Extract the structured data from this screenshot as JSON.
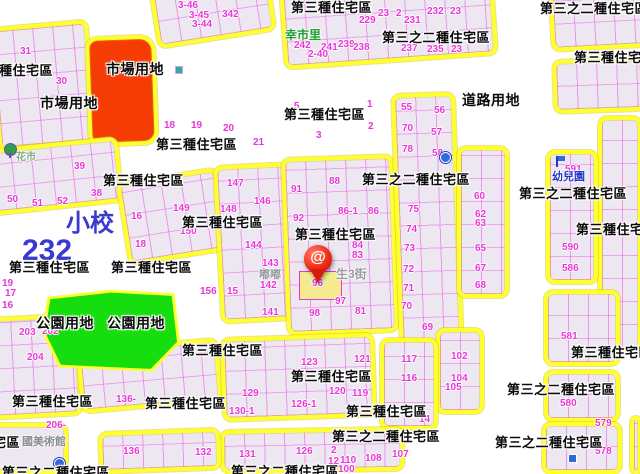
{
  "map": {
    "marker": {
      "glyph": "@",
      "on_parcel": "96"
    },
    "colors": {
      "background": "#ffffff",
      "block_fill": "#ece7f1",
      "parcel_line": "#ee3ee4",
      "zone_border_yellow": "#feff2e",
      "market_red": "#f53c05",
      "park_green": "#16dd0e",
      "highlight_yellow": "#f4eb8e",
      "number_magenta": "#e935d8",
      "label_black": "#0b0b0b",
      "pin_red": "#ef2c17"
    },
    "zone_labels": [
      {
        "t": "第三種住宅區",
        "x": -28,
        "y": 64
      },
      {
        "t": "市場用地",
        "x": 106,
        "y": 62,
        "fs": 14
      },
      {
        "t": "市場用地",
        "x": 40,
        "y": 96,
        "fs": 14
      },
      {
        "t": "第三種住宅區",
        "x": 291,
        "y": 1
      },
      {
        "t": "第三之二種住宅區",
        "x": 382,
        "y": 31
      },
      {
        "t": "第三之二種住宅區",
        "x": 540,
        "y": 2
      },
      {
        "t": "第三種住宅區",
        "x": 574,
        "y": 51
      },
      {
        "t": "道路用地",
        "x": 462,
        "y": 93,
        "fs": 14
      },
      {
        "t": "第三種住宅區",
        "x": 156,
        "y": 138
      },
      {
        "t": "第三種住宅區",
        "x": 284,
        "y": 108
      },
      {
        "t": "第三種住宅區",
        "x": 103,
        "y": 174
      },
      {
        "t": "第三種住宅區",
        "x": 182,
        "y": 216
      },
      {
        "t": "第三種住宅區",
        "x": 295,
        "y": 228
      },
      {
        "t": "第三之二種住宅區",
        "x": 362,
        "y": 173
      },
      {
        "t": "第三種住宅區",
        "x": 9,
        "y": 261
      },
      {
        "t": "第三種住宅區",
        "x": 111,
        "y": 261
      },
      {
        "t": "第三之二種住宅區",
        "x": 519,
        "y": 187
      },
      {
        "t": "第三種住宅區",
        "x": 576,
        "y": 223
      },
      {
        "t": "公園用地",
        "x": 36,
        "y": 316,
        "fs": 14
      },
      {
        "t": "公園用地",
        "x": 107,
        "y": 316,
        "fs": 14
      },
      {
        "t": "第三種住宅區",
        "x": 182,
        "y": 344
      },
      {
        "t": "第三種住宅區",
        "x": 571,
        "y": 346
      },
      {
        "t": "第三種住宅區",
        "x": 12,
        "y": 395
      },
      {
        "t": "第三種住宅區",
        "x": 145,
        "y": 397
      },
      {
        "t": "第三種住宅區",
        "x": 291,
        "y": 370
      },
      {
        "t": "第三種住宅區",
        "x": 346,
        "y": 405
      },
      {
        "t": "第三之二種住宅區",
        "x": 332,
        "y": 430
      },
      {
        "t": "第三之二種住宅區",
        "x": 507,
        "y": 383
      },
      {
        "t": "第三之二種住宅區",
        "x": 495,
        "y": 436
      },
      {
        "t": "第三之二種住宅區",
        "x": 231,
        "y": 465
      },
      {
        "t": "第三之二種住宅區",
        "x": -88,
        "y": 436
      },
      {
        "t": "第三之二種住宅區",
        "x": 2,
        "y": 466
      }
    ],
    "parcel_numbers": [
      {
        "t": "31",
        "x": 20,
        "y": 47
      },
      {
        "t": "30",
        "x": 56,
        "y": 77
      },
      {
        "t": "18",
        "x": 164,
        "y": 121
      },
      {
        "t": "19",
        "x": 191,
        "y": 121
      },
      {
        "t": "3-46",
        "x": 178,
        "y": 1
      },
      {
        "t": "3-45",
        "x": 189,
        "y": 11
      },
      {
        "t": "3-44",
        "x": 192,
        "y": 20
      },
      {
        "t": "342",
        "x": 222,
        "y": 10
      },
      {
        "t": "242",
        "x": 294,
        "y": 41
      },
      {
        "t": "241",
        "x": 321,
        "y": 43
      },
      {
        "t": "239",
        "x": 338,
        "y": 40
      },
      {
        "t": "238",
        "x": 353,
        "y": 43
      },
      {
        "t": "2-40",
        "x": 308,
        "y": 50
      },
      {
        "t": "229",
        "x": 359,
        "y": 16
      },
      {
        "t": "23",
        "x": 378,
        "y": 9
      },
      {
        "t": "2",
        "x": 396,
        "y": 9
      },
      {
        "t": "231",
        "x": 404,
        "y": 16
      },
      {
        "t": "237",
        "x": 401,
        "y": 44
      },
      {
        "t": "232",
        "x": 427,
        "y": 7
      },
      {
        "t": "23",
        "x": 450,
        "y": 7
      },
      {
        "t": "235",
        "x": 427,
        "y": 45
      },
      {
        "t": "23",
        "x": 451,
        "y": 45
      },
      {
        "t": "5",
        "x": 294,
        "y": 102
      },
      {
        "t": "1",
        "x": 367,
        "y": 100
      },
      {
        "t": "3",
        "x": 316,
        "y": 131
      },
      {
        "t": "2",
        "x": 368,
        "y": 122
      },
      {
        "t": "20",
        "x": 223,
        "y": 124
      },
      {
        "t": "21",
        "x": 253,
        "y": 138
      },
      {
        "t": "39",
        "x": 74,
        "y": 162
      },
      {
        "t": "38",
        "x": 91,
        "y": 189
      },
      {
        "t": "50",
        "x": 7,
        "y": 195
      },
      {
        "t": "51",
        "x": 32,
        "y": 199
      },
      {
        "t": "52",
        "x": 57,
        "y": 197
      },
      {
        "t": "16",
        "x": 131,
        "y": 212
      },
      {
        "t": "18",
        "x": 135,
        "y": 240
      },
      {
        "t": "149",
        "x": 173,
        "y": 204
      },
      {
        "t": "150",
        "x": 180,
        "y": 227
      },
      {
        "t": "156",
        "x": 200,
        "y": 287
      },
      {
        "t": "19",
        "x": 2,
        "y": 279
      },
      {
        "t": "17",
        "x": 5,
        "y": 289
      },
      {
        "t": "16",
        "x": 2,
        "y": 301
      },
      {
        "t": "147",
        "x": 227,
        "y": 179
      },
      {
        "t": "146",
        "x": 254,
        "y": 197
      },
      {
        "t": "148",
        "x": 220,
        "y": 205
      },
      {
        "t": "144",
        "x": 245,
        "y": 241
      },
      {
        "t": "143",
        "x": 262,
        "y": 259
      },
      {
        "t": "142",
        "x": 260,
        "y": 281
      },
      {
        "t": "15",
        "x": 227,
        "y": 287
      },
      {
        "t": "141",
        "x": 262,
        "y": 308
      },
      {
        "t": "88",
        "x": 329,
        "y": 177
      },
      {
        "t": "91",
        "x": 291,
        "y": 185
      },
      {
        "t": "92",
        "x": 293,
        "y": 214
      },
      {
        "t": "86-1",
        "x": 338,
        "y": 207
      },
      {
        "t": "86",
        "x": 368,
        "y": 207
      },
      {
        "t": "84",
        "x": 352,
        "y": 241
      },
      {
        "t": "83",
        "x": 352,
        "y": 251
      },
      {
        "t": "96",
        "x": 312,
        "y": 279
      },
      {
        "t": "97",
        "x": 335,
        "y": 297
      },
      {
        "t": "98",
        "x": 309,
        "y": 309
      },
      {
        "t": "81",
        "x": 355,
        "y": 307
      },
      {
        "t": "55",
        "x": 401,
        "y": 103
      },
      {
        "t": "70",
        "x": 402,
        "y": 124
      },
      {
        "t": "78",
        "x": 402,
        "y": 145
      },
      {
        "t": "56",
        "x": 434,
        "y": 106
      },
      {
        "t": "57",
        "x": 431,
        "y": 128
      },
      {
        "t": "58",
        "x": 432,
        "y": 149
      },
      {
        "t": "75",
        "x": 408,
        "y": 205
      },
      {
        "t": "74",
        "x": 406,
        "y": 225
      },
      {
        "t": "73",
        "x": 404,
        "y": 244
      },
      {
        "t": "72",
        "x": 403,
        "y": 265
      },
      {
        "t": "71",
        "x": 403,
        "y": 284
      },
      {
        "t": "70",
        "x": 401,
        "y": 302
      },
      {
        "t": "69",
        "x": 422,
        "y": 323
      },
      {
        "t": "60",
        "x": 474,
        "y": 192
      },
      {
        "t": "62",
        "x": 475,
        "y": 210
      },
      {
        "t": "63",
        "x": 475,
        "y": 219
      },
      {
        "t": "65",
        "x": 475,
        "y": 244
      },
      {
        "t": "67",
        "x": 475,
        "y": 264
      },
      {
        "t": "68",
        "x": 475,
        "y": 281
      },
      {
        "t": "102",
        "x": 451,
        "y": 352
      },
      {
        "t": "104",
        "x": 451,
        "y": 374
      },
      {
        "t": "105",
        "x": 445,
        "y": 383
      },
      {
        "t": "591",
        "x": 565,
        "y": 165
      },
      {
        "t": "590",
        "x": 562,
        "y": 243
      },
      {
        "t": "586",
        "x": 562,
        "y": 264
      },
      {
        "t": "581",
        "x": 561,
        "y": 332
      },
      {
        "t": "580",
        "x": 560,
        "y": 399
      },
      {
        "t": "579",
        "x": 595,
        "y": 419
      },
      {
        "t": "578",
        "x": 595,
        "y": 447
      },
      {
        "t": "203",
        "x": 19,
        "y": 328
      },
      {
        "t": "202",
        "x": 42,
        "y": 327
      },
      {
        "t": "204",
        "x": 27,
        "y": 353
      },
      {
        "t": "206-",
        "x": 46,
        "y": 421
      },
      {
        "t": "136-",
        "x": 116,
        "y": 395
      },
      {
        "t": "136",
        "x": 123,
        "y": 447
      },
      {
        "t": "132",
        "x": 195,
        "y": 448
      },
      {
        "t": "123",
        "x": 301,
        "y": 358
      },
      {
        "t": "121",
        "x": 354,
        "y": 355
      },
      {
        "t": "120",
        "x": 329,
        "y": 387
      },
      {
        "t": "119",
        "x": 352,
        "y": 389
      },
      {
        "t": "117",
        "x": 401,
        "y": 355
      },
      {
        "t": "116",
        "x": 401,
        "y": 374
      },
      {
        "t": "129",
        "x": 242,
        "y": 389
      },
      {
        "t": "126-1",
        "x": 291,
        "y": 400
      },
      {
        "t": "130-1",
        "x": 229,
        "y": 407
      },
      {
        "t": "14",
        "x": 419,
        "y": 415
      },
      {
        "t": "131",
        "x": 239,
        "y": 450
      },
      {
        "t": "126",
        "x": 296,
        "y": 447
      },
      {
        "t": "2",
        "x": 331,
        "y": 446
      },
      {
        "t": "12",
        "x": 328,
        "y": 457
      },
      {
        "t": "110",
        "x": 340,
        "y": 456
      },
      {
        "t": "108",
        "x": 365,
        "y": 454
      },
      {
        "t": "107",
        "x": 392,
        "y": 450
      },
      {
        "t": "100",
        "x": 338,
        "y": 465
      }
    ],
    "poi_labels": [
      {
        "t": "幸市里",
        "x": 285,
        "y": 29,
        "c": "#1f9e33",
        "fs": 12
      },
      {
        "t": "幼兒園",
        "x": 552,
        "y": 172,
        "c": "#2437c8",
        "fs": 11
      },
      {
        "t": "小校",
        "x": 66,
        "y": 212,
        "c": "#3a3ad0",
        "fs": 24
      },
      {
        "t": "232",
        "x": 22,
        "y": 236,
        "c": "#3a3ad0",
        "fs": 30
      },
      {
        "t": "花市",
        "x": 16,
        "y": 153,
        "c": "#7fae7f",
        "fs": 10
      },
      {
        "t": "國美術館",
        "x": 22,
        "y": 437,
        "c": "#8a8f96",
        "fs": 11
      },
      {
        "t": "嘟嘟",
        "x": 259,
        "y": 270,
        "c": "#9a9aa2",
        "fs": 11
      },
      {
        "t": "生3街",
        "x": 336,
        "y": 268,
        "c": "#9a9aa2",
        "fs": 12
      }
    ]
  }
}
